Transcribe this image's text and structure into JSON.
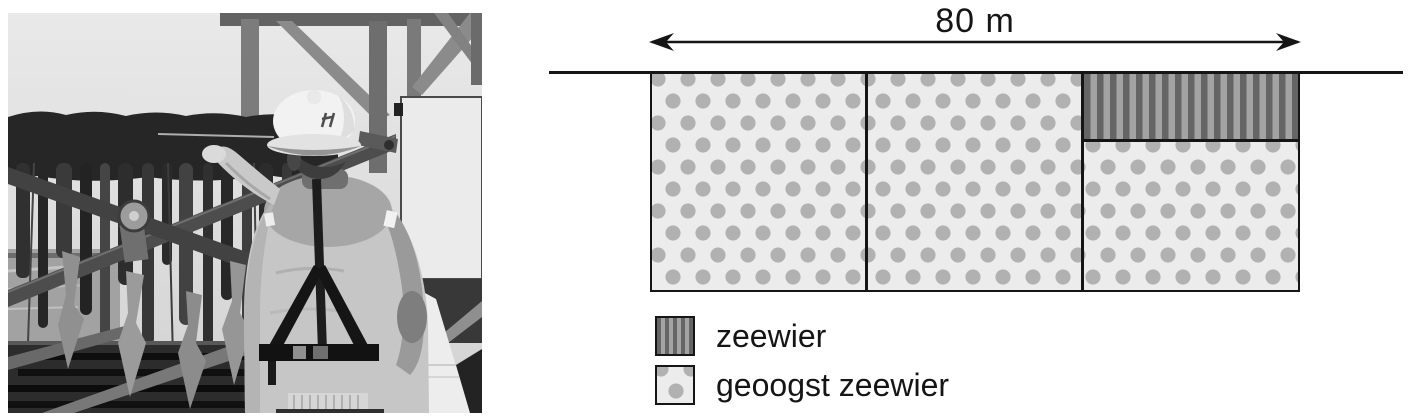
{
  "photo": {
    "description": "Black-and-white photo of a worker wearing a white hard hat, life vest and harness, harvesting dark seaweed strands hanging from a line on a boat rig"
  },
  "diagram": {
    "width_label": "80 m",
    "sections": [
      {
        "name": "section-1",
        "pattern": "dots",
        "meaning": "geoogst zeewier"
      },
      {
        "name": "section-2",
        "pattern": "dots",
        "meaning": "geoogst zeewier"
      },
      {
        "name": "section-3-top",
        "pattern": "stripes",
        "meaning": "zeewier"
      },
      {
        "name": "section-3-bottom",
        "pattern": "dots",
        "meaning": "geoogst zeewier"
      }
    ],
    "legend": {
      "items": [
        {
          "pattern": "stripes",
          "label": "zeewier"
        },
        {
          "pattern": "dots",
          "label": "geoogst zeewier"
        }
      ]
    },
    "colors": {
      "stripe_dark": "#656565",
      "stripe_light": "#a3a3a3",
      "dot_fill": "#b1b1b1",
      "dot_background": "#ececec",
      "line": "#151515"
    }
  }
}
